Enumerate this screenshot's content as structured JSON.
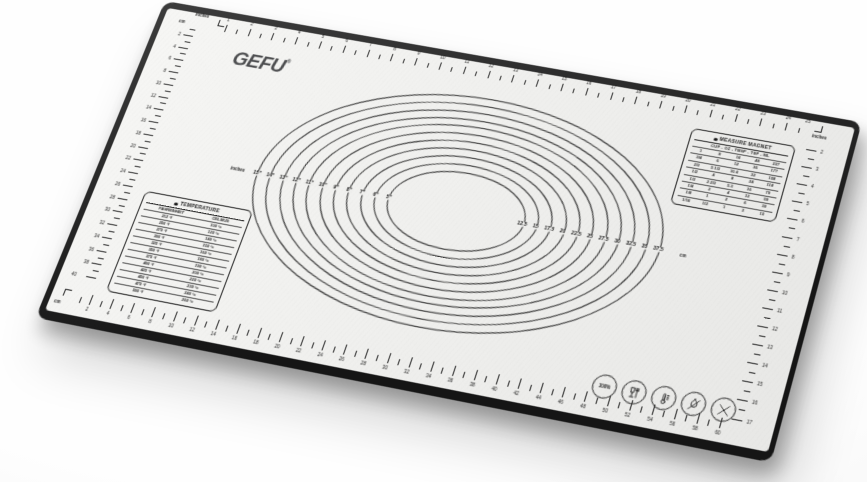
{
  "brand": {
    "logo": "GEFU",
    "registered": "®"
  },
  "mat": {
    "surface_color": "#f0f0ee",
    "edge_color": "#1a1a1a",
    "line_color": "#262626"
  },
  "rulers": {
    "top": {
      "unit_label": "inches",
      "labels": [
        1,
        2,
        3,
        4,
        5,
        6,
        7,
        8,
        9,
        10,
        11,
        12,
        13,
        14,
        15,
        16,
        17,
        18,
        19,
        20,
        21,
        22,
        23,
        24
      ],
      "end_label": "25"
    },
    "left": {
      "unit_label": "cm",
      "labels": [
        2,
        4,
        6,
        8,
        10,
        12,
        14,
        16,
        18,
        20,
        22,
        24,
        26,
        28,
        30,
        32,
        34,
        36,
        38
      ],
      "end_label": "40"
    },
    "bottom": {
      "unit_label": "cm",
      "labels": [
        2,
        4,
        6,
        8,
        10,
        12,
        14,
        16,
        18,
        20,
        22,
        24,
        26,
        28,
        30,
        32,
        34,
        36,
        38,
        40,
        42,
        44,
        46,
        48,
        50,
        52,
        54,
        56,
        58,
        60
      ]
    },
    "right": {
      "unit_label": "inches",
      "labels": [
        2,
        3,
        4,
        5,
        6,
        7,
        8,
        9,
        10,
        11,
        12,
        13,
        14,
        15,
        16,
        17
      ]
    }
  },
  "circles": {
    "inch_unit_label": "inches",
    "cm_unit_label": "cm",
    "diameters_in": [
      15,
      14,
      13,
      12,
      11,
      10,
      9,
      8,
      7,
      6,
      5
    ],
    "inch_labels": [
      "15\"",
      "14\"",
      "13\"",
      "12\"",
      "11\"",
      "10\"",
      "9\"",
      "8\"",
      "7\"",
      "6\"",
      "5\""
    ],
    "cm_labels": [
      "37.5",
      "35",
      "32.5",
      "30",
      "27.5",
      "25",
      "22.5",
      "20",
      "17.5",
      "15",
      "12.5"
    ]
  },
  "temperature_table": {
    "title": "TEMPERATURE",
    "columns": [
      "FAHRENHEIT",
      "CELSIUS"
    ],
    "rows": [
      [
        "212 °f",
        "100 °c"
      ],
      [
        "250 °f",
        "120 °c"
      ],
      [
        "275 °f",
        "140 °c"
      ],
      [
        "300 °f",
        "150 °c"
      ],
      [
        "325 °f",
        "160 °c"
      ],
      [
        "350 °f",
        "180 °c"
      ],
      [
        "375 °f",
        "190 °c"
      ],
      [
        "400 °f",
        "200 °c"
      ],
      [
        "425 °f",
        "220 °c"
      ],
      [
        "450 °f",
        "230 °c"
      ],
      [
        "475 °f",
        "240 °c"
      ],
      [
        "500 °f",
        "260 °c"
      ]
    ]
  },
  "measure_table": {
    "title": "MEASURE MAGNET",
    "columns_label": "CUP - OZ - TBSP - TSP - ML",
    "rows": [
      [
        "1",
        "8",
        "16",
        "48",
        "237"
      ],
      [
        "3/4",
        "6",
        "12",
        "36",
        "177"
      ],
      [
        "2/3",
        "5 1/3",
        "10.6",
        "32",
        "158"
      ],
      [
        "1/2",
        "4",
        "8",
        "24",
        "118"
      ],
      [
        "1/3",
        "2 2/3",
        "5.3",
        "16",
        "79"
      ],
      [
        "1/4",
        "2",
        "4",
        "12",
        "59"
      ],
      [
        "1/8",
        "1",
        "2",
        "6",
        "30"
      ],
      [
        "1/16",
        "1/2",
        "1",
        "3",
        "15"
      ]
    ]
  },
  "icons": [
    {
      "name": "100-percent-icon",
      "label": "100%"
    },
    {
      "name": "dishwasher-safe-icon"
    },
    {
      "name": "temperature-range-icon"
    },
    {
      "name": "no-open-flame-icon"
    },
    {
      "name": "no-cutting-icon"
    }
  ]
}
